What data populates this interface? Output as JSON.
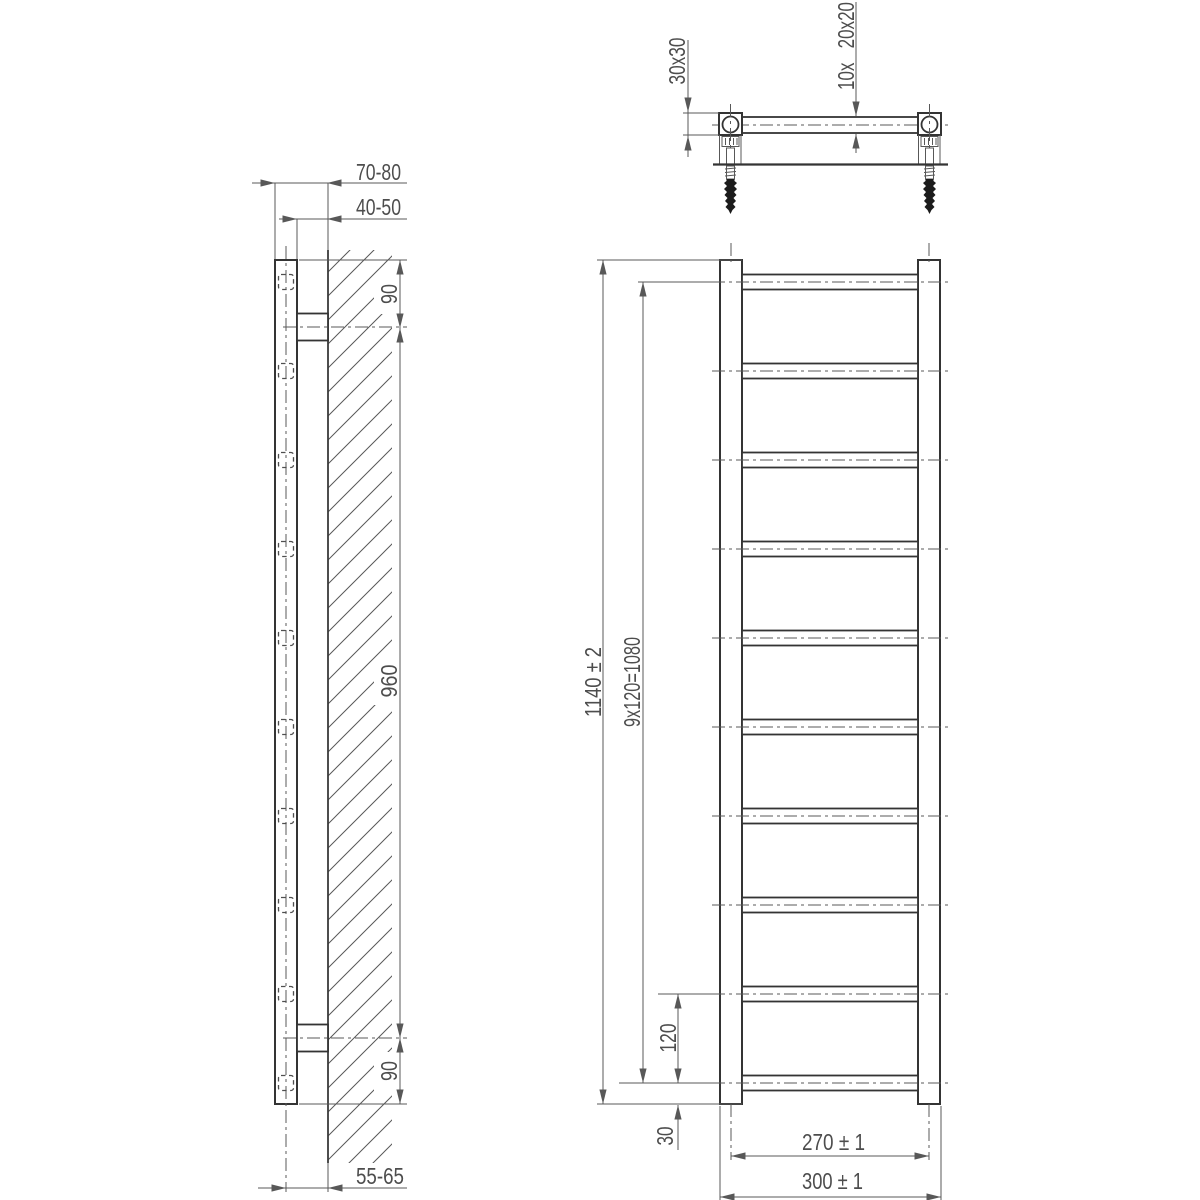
{
  "drawing_type": "technical dimension drawing, ladder towel radiator",
  "colors": {
    "background": "#ffffff",
    "object_line": "#343434",
    "thin_line": "#585858",
    "text": "#4d4d4d",
    "anchor_fill": "#1c1c1c"
  },
  "side_view": {
    "dim_depth_total": "70-80",
    "dim_depth_gap": "40-50",
    "dim_top_offset": "90",
    "dim_bracket_span": "960",
    "dim_bottom_offset": "90",
    "dim_bottom_depth": "55-65"
  },
  "front_view": {
    "dim_height": "1140 ± 2",
    "dim_rung_pitch_total": "9x120=1080",
    "dim_rung_pitch": "120",
    "dim_bottom_margin": "30",
    "dim_width_centers": "270 ± 1",
    "dim_width_overall": "300 ± 1"
  },
  "top_view": {
    "dim_post_section": "30x30",
    "dim_tube_section": "10x   20x20"
  }
}
